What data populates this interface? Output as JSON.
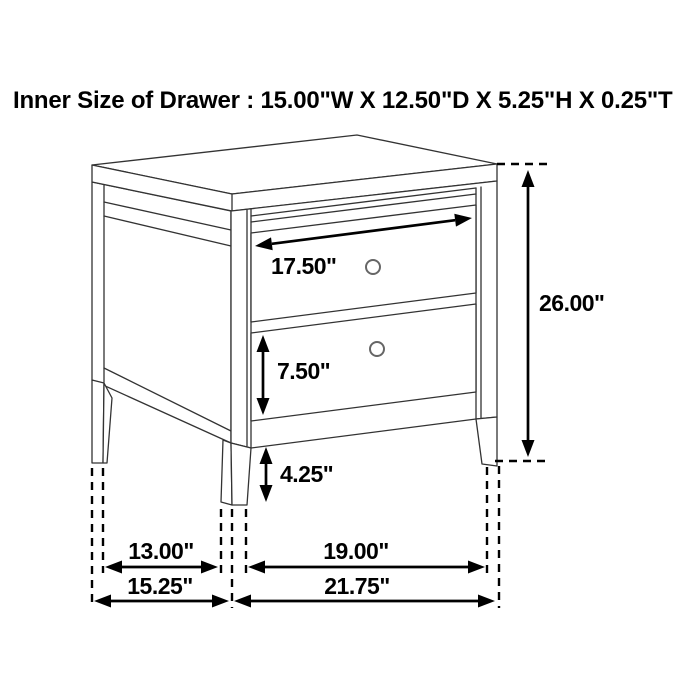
{
  "title": "Inner Size of Drawer : 15.00\"W X 12.50\"D X 5.25\"H X 0.25\"T",
  "inner_drawer_size": {
    "width": "15.00\"",
    "depth": "12.50\"",
    "height": "5.25\"",
    "thickness": "0.25\""
  },
  "figure": {
    "type": "furniture-dimension-diagram",
    "subject": "two-drawer nightstand line drawing",
    "drawer_count": "2"
  },
  "dims": {
    "drawer_width": "17.50\"",
    "overall_height": "26.00\"",
    "drawer_front_height": "7.50\"",
    "leg_height": "4.25\"",
    "leg_spacing_depth": "13.00\"",
    "overall_depth": "15.25\"",
    "leg_spacing_width": "19.00\"",
    "overall_width": "21.75\""
  },
  "colors": {
    "background": "#ffffff",
    "dimension_ink": "#000000",
    "furniture_line": "#333333",
    "knob_ring": "#666666"
  }
}
